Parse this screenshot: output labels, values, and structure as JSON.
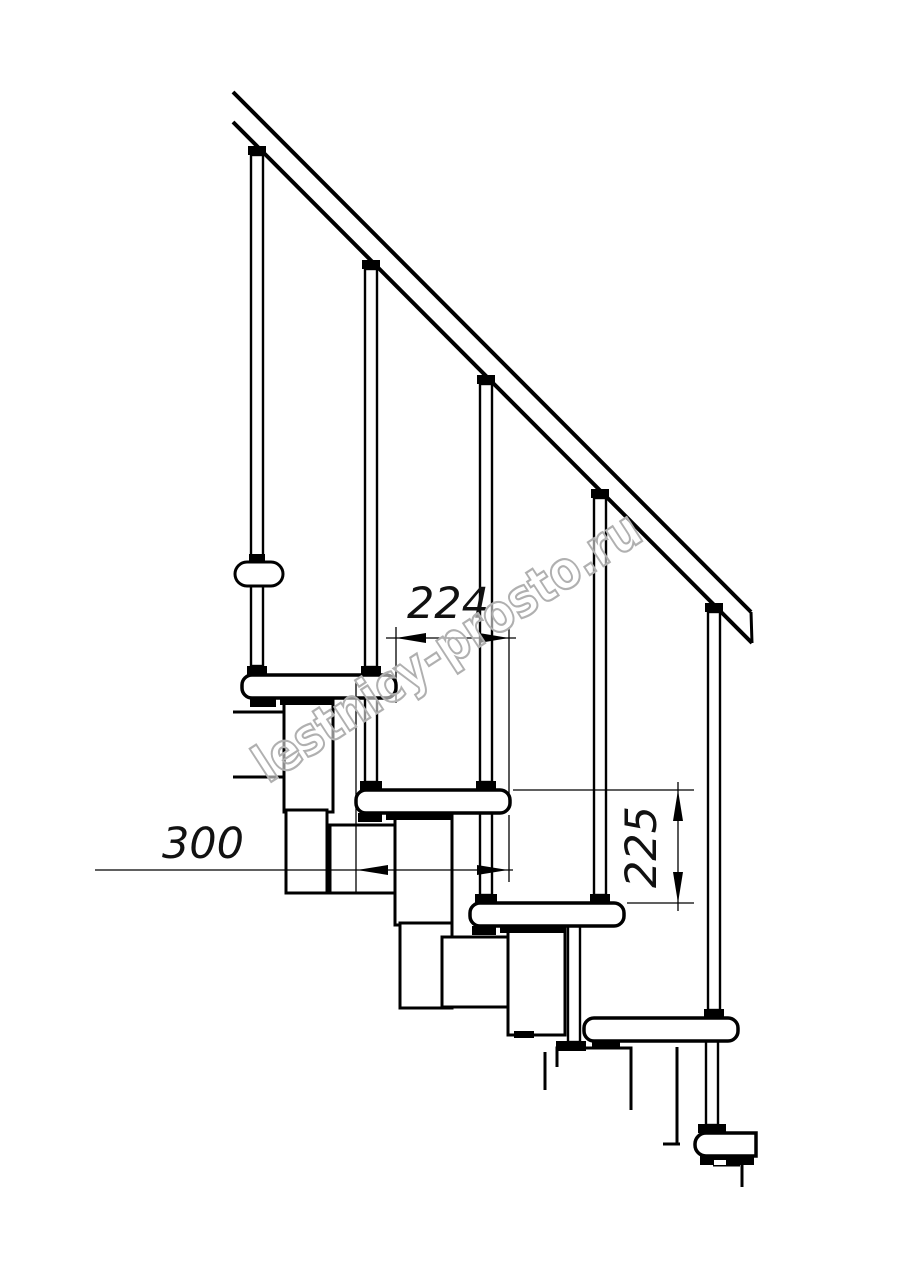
{
  "figure": {
    "kind": "staircase-side-view-technical-drawing",
    "treads_visible": 5,
    "balusters_visible": 5,
    "handrail": true
  },
  "dimension_labels": {
    "step_run": "224",
    "tread_depth": "300",
    "riser_height": "225"
  },
  "watermark": {
    "text": "lestnicy-prosto.ru"
  },
  "colors": {
    "background": "#ffffff",
    "line": "#000000",
    "dimension_text": "#111111",
    "watermark_outline": "#b0b0b0",
    "watermark_fill": "rgba(255,255,255,0.55)"
  }
}
